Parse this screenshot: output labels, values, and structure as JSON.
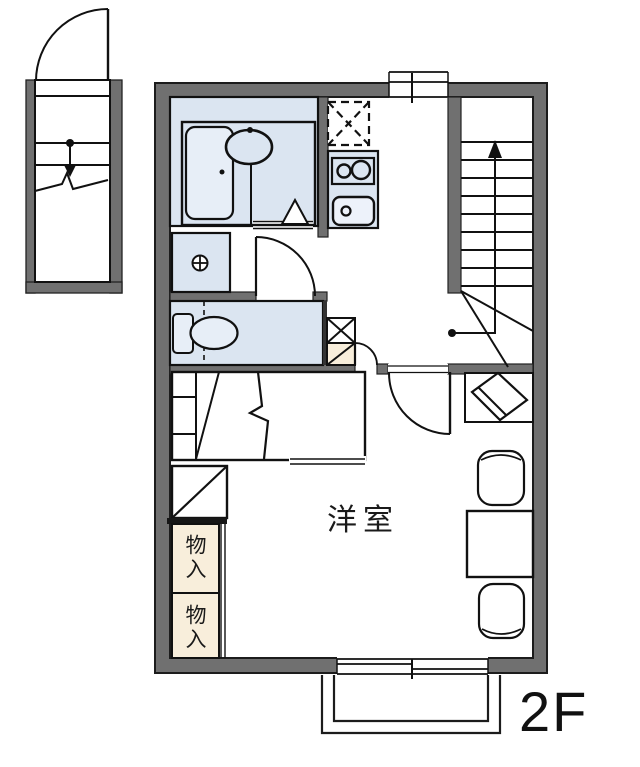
{
  "document": {
    "type": "floor-plan",
    "floor": "2F"
  },
  "labels": {
    "western_room": "洋室",
    "floor": "2F"
  },
  "storage_closets": [
    {
      "label": "物入"
    },
    {
      "label": "物入"
    }
  ],
  "colors": {
    "wall": "#707070",
    "wall_outline": "#1c1c1c",
    "line": "#111111",
    "room_blue": "#dbe5f1",
    "fixture_blue": "#e7eef7",
    "sink_white": "#edf2fa",
    "closet_cream": "#f8eedb",
    "background": "#ffffff"
  },
  "symbols": [
    {
      "name": "entrance-door-swing-icon",
      "shape": "quarter-arc door leaf"
    },
    {
      "name": "stair-break-line-icon",
      "shape": "zigzag break line"
    },
    {
      "name": "down-arrow-icon",
      "shape": "dot with arrow, entrance stairs"
    },
    {
      "name": "up-arrow-icon",
      "shape": "dot with long up arrow on staircase"
    },
    {
      "name": "refrigerator-space-icon",
      "shape": "dashed square with X"
    },
    {
      "name": "two-burner-stove-icon",
      "shape": "box with two circles"
    },
    {
      "name": "kitchen-sink-icon",
      "shape": "rounded box with drain circle"
    },
    {
      "name": "bathtub-icon",
      "shape": "rounded rectangle tub"
    },
    {
      "name": "washbasin-icon",
      "shape": "oval basin with tap dot"
    },
    {
      "name": "washing-machine-pan-icon",
      "shape": "square with crossed circle"
    },
    {
      "name": "toilet-icon",
      "shape": "tank and bowl"
    },
    {
      "name": "door-swing-icon",
      "shape": "quarter-circle swing arcs"
    },
    {
      "name": "sliding-window-icon",
      "shape": "double-line window with center tick"
    },
    {
      "name": "tv-on-stand-icon",
      "shape": "tilted rectangle in square"
    },
    {
      "name": "table-icon",
      "shape": "square table"
    },
    {
      "name": "chair-icon",
      "shape": "rounded chair seats"
    },
    {
      "name": "closet-diagonal-icon",
      "shape": "square with diagonal"
    },
    {
      "name": "pipe-space-icon",
      "shape": "square with X"
    },
    {
      "name": "balcony-icon",
      "shape": "nested open rectangles"
    }
  ]
}
